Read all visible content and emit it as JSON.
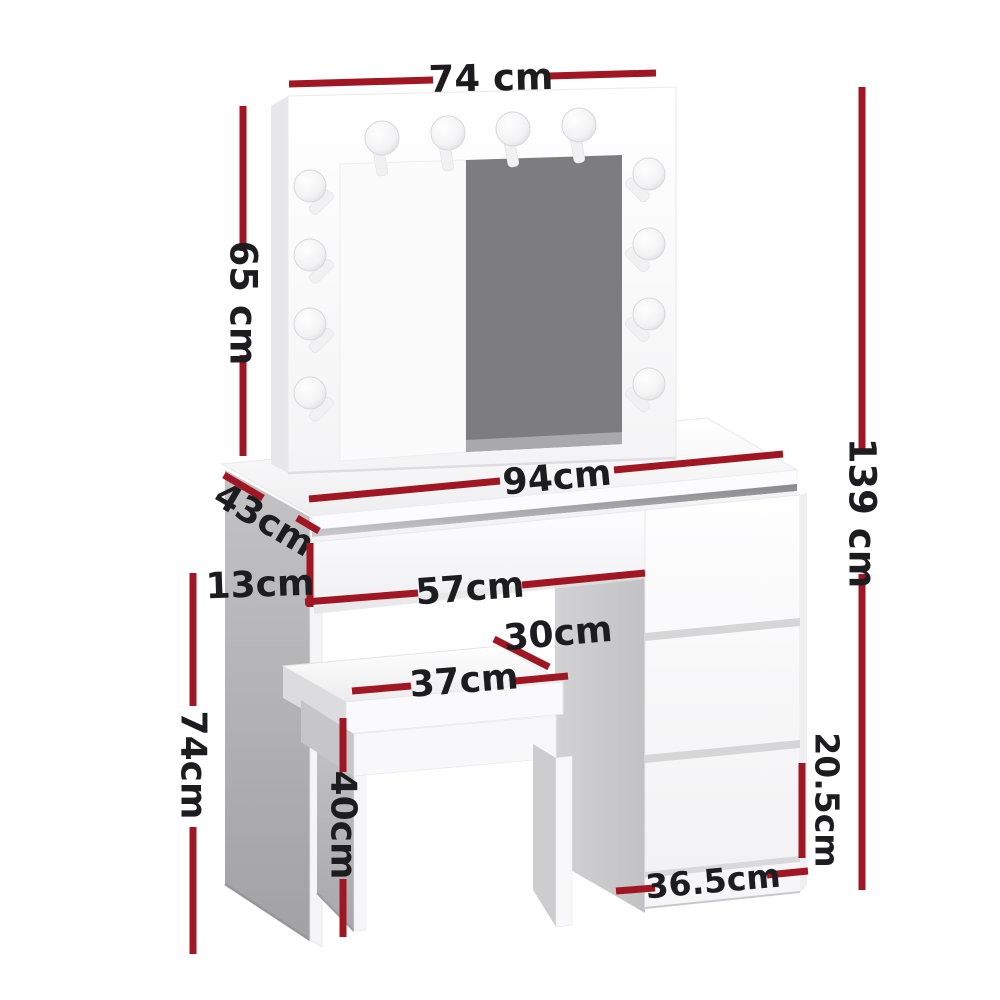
{
  "diagram": {
    "type": "furniture-dimension-diagram",
    "product": "dressing table with lighted mirror, stool and drawer pedestal",
    "background": "#ffffff",
    "dimension_line_color": "#a01623",
    "label_color": "#1d1d1f",
    "mirror_glass_color": "#7d7d7f",
    "panel_shadow_color": "#ababad",
    "bulb_count": 12
  },
  "labels": {
    "mirror_width": "74 cm",
    "mirror_height": "65 cm",
    "total_height": "139 cm",
    "desk_width": "94cm",
    "desk_depth": "43cm",
    "drawer_height": "13cm",
    "drawer_width": "57cm",
    "stool_depth": "30cm",
    "stool_width": "37cm",
    "stool_height": "40cm",
    "desk_height": "74cm",
    "side_drawer_height": "20.5cm",
    "side_drawer_width": "36.5cm"
  }
}
